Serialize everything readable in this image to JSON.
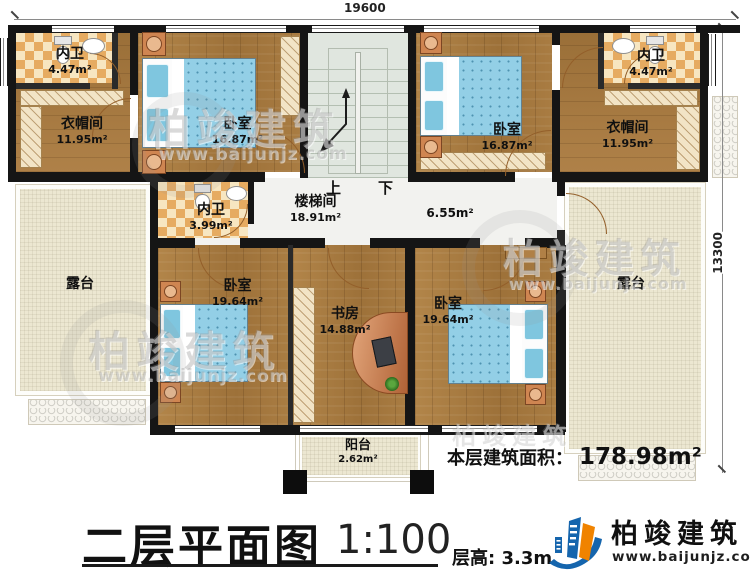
{
  "dimensions": {
    "top": "19600",
    "right": "13300"
  },
  "stairs": {
    "up": "上",
    "down": "下"
  },
  "watermark": {
    "brand": "柏竣建筑",
    "site": "www.baijunjz.com"
  },
  "rooms": {
    "bath_tl": {
      "name": "内卫",
      "area": "4.47m²"
    },
    "wardrobe_l": {
      "name": "衣帽间",
      "area": "11.95m²"
    },
    "bedroom_tl": {
      "name": "卧室",
      "area": "16.87m²"
    },
    "bedroom_tr": {
      "name": "卧室",
      "area": "16.87m²"
    },
    "wardrobe_r": {
      "name": "衣帽间",
      "area": "11.95m²"
    },
    "bath_tr": {
      "name": "内卫",
      "area": "4.47m²"
    },
    "bath_mid": {
      "name": "内卫",
      "area": "3.99m²"
    },
    "stair_hall": {
      "name": "楼梯间",
      "area": "18.91m²"
    },
    "hall": {
      "area": "6.55m²"
    },
    "terrace_l": {
      "name": "露台"
    },
    "terrace_r": {
      "name": "露台"
    },
    "bedroom_bl": {
      "name": "卧室",
      "area": "19.64m²"
    },
    "study": {
      "name": "书房",
      "area": "14.88m²"
    },
    "bedroom_br": {
      "name": "卧室",
      "area": "19.64m²"
    },
    "balcony": {
      "name": "阳台",
      "area": "2.62m²"
    }
  },
  "footer": {
    "floor_area_label": "本层建筑面积：",
    "floor_area_value": "178.98m²",
    "title": "二层平面图",
    "scale": "1:100",
    "floor_height": "层高: 3.3m",
    "brand": "柏竣建筑",
    "brand_site": "www.baijunjz.com"
  },
  "colors": {
    "wall": "#151515",
    "wood": "#a87d45",
    "tile_accent": "#e6ab61",
    "terrace": "#ece7d1",
    "stairwell": "#e0e6df",
    "bed": "#93cfe6",
    "logo_blue": "#1565ad",
    "logo_orange": "#f08300"
  }
}
